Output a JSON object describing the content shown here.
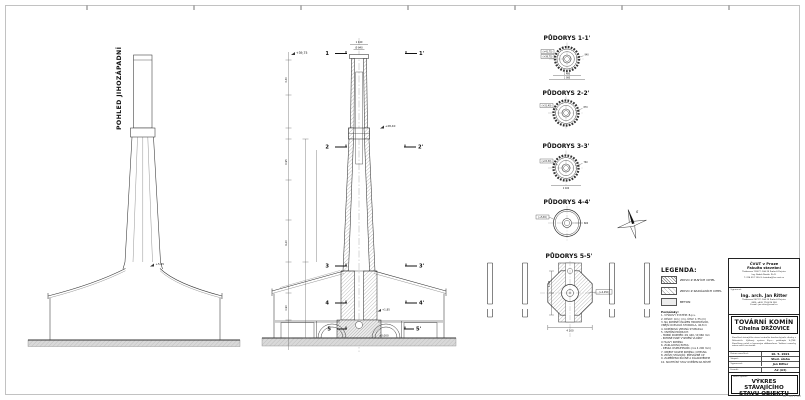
{
  "sheet": {
    "format_note": "A2 · 594 × 420",
    "line_color": "#333333",
    "ground_color": "#d9d9d9"
  },
  "elevation": {
    "title": "POHLED JIHOZÁPADNÍ",
    "level_collar": "+5,65"
  },
  "section": {
    "cuts": [
      "1",
      "1'",
      "2",
      "2'",
      "3",
      "3'",
      "4",
      "4'",
      "5",
      "5'"
    ],
    "level_top": "+39,75",
    "level_collar": "+28,40",
    "level_attic": "+1,85",
    "level_ground": "±0,000",
    "dim_top_outer": "1 440",
    "dim_top_inner": "Ø 940",
    "dims": [
      "3,30",
      "6,95",
      "9,20",
      "4,90"
    ]
  },
  "plans": [
    {
      "title": "PŮDORYS 1-1'",
      "left1": "(+41,75)",
      "left2": "(+39,75)",
      "right": "940",
      "below1": "1 480",
      "below2": "1 980"
    },
    {
      "title": "PŮDORYS 2-2'",
      "left1": "(+31,40)",
      "right": "870"
    },
    {
      "title": "PŮDORYS 3-3'",
      "left1": "(+15,30)",
      "right": "760",
      "below1": "2 400"
    },
    {
      "title": "PŮDORYS 4-4'",
      "left1": "(+5,65)",
      "right": "600"
    },
    {
      "title": "PŮDORYS 5-5'",
      "dim_left": "1 700",
      "dim_bottom": "4 200",
      "box_right": "(+0,450)"
    }
  ],
  "north": {
    "label": "S"
  },
  "legend": {
    "title": "LEGENDA:",
    "items": [
      {
        "label": "ZDIVO Z PLNÝCH CIHEL"
      },
      {
        "label": "ZDIVO Z RADIÁLNÍCH CIHEL"
      },
      {
        "label": "BETON"
      }
    ],
    "notes_title": "Poznámky:",
    "notes": [
      "1. VÝŠKOVÝ SYSTÉM: B.p.v.",
      "2. DÉLKY: mm | (m), ÚHLY: 1:75 (m)",
      "3. NA KOMÍNĚ OSAZEN HROMOSVOD,",
      "    VNĚJŠÍ OCELOVÁ STUPADLA, 40,8 m",
      "4. KOMÍNOVÁ VRTANÁ STUPADLA",
      "5. VNITŘNÍ PRŮDUCH:",
      "    - HORNÍ ROZMĚR: Ø1 440 / Ø 960 mm",
      "    - PATRNÉ PLNÉ VYZDĚNÍ VLOŽKY",
      "      U HLAVY KOMÍNA",
      "6. ZÁKLADOVÁ PATKA:",
      "    - DESKA OSMIÚHELNÍK (cca 4 200 mm)",
      "7. OBJEKT KOLEM KOMÍNA: CIHELNA",
      "8. ZDIVO STÁVAJÍCÍ: PŘEVÁŽNĚ CP",
      "9. ZAMĚŘENO RUČNĚ A DÁLKOMĚREM",
      "10. SKUTEČNÝ STAV OVĚŘEN NA MÍSTĚ"
    ]
  },
  "titleblock": {
    "univ": {
      "line1": "ČVUT v Praze",
      "line2": "Fakulta stavební",
      "addr": "Thákurova 7/2077, 166 29 Praha 6 Dejvice\nIng. Radek Novák, Ph.D.\nT: 224 357 130, E: katedra@fsv.cvut.cz"
    },
    "author": {
      "label": "Vypracoval:",
      "name": "Ing. arch. Jan Ritter",
      "addr": "Thákurova 2077/7, 166 29 Praha 6 Dejvice\nGSM: +420 774 476 258\nE-mail: jan.ritter@email.cz"
    },
    "project": {
      "label": "Akce:",
      "title": "TOVÁRNÍ KOMÍN",
      "subtitle": "Cihelna DRŽOVICE",
      "description": "Zaměření stávajícího stavu továrního komína bývalé cihelny v Držovicích. Výškový systém B.p.v., polohopis S-JTSK. Zaměřeno ručně a laserovým dálkoměrem. Veškeré rozměry nutno ověřit na stavbě."
    },
    "table": [
      {
        "label": "Datum zaměření:",
        "value": "10. 5. 2021"
      },
      {
        "label": "Stupeň:",
        "value": "Stud. úloha"
      },
      {
        "label": "Vypracoval:",
        "value": "Jan Ritter"
      },
      {
        "label": "Formát:",
        "value": "A2 (A3)"
      }
    ],
    "drawing": {
      "label": "Název výkresu:",
      "title": "VÝKRES STÁVAJÍCÍHO\nSTAVU OBJEKTU"
    },
    "scale": {
      "label": "Měřítko:",
      "value": "1 : 100 ( : 200)"
    },
    "number": {
      "label": "Číslo výkresu:",
      "value": "01"
    }
  }
}
